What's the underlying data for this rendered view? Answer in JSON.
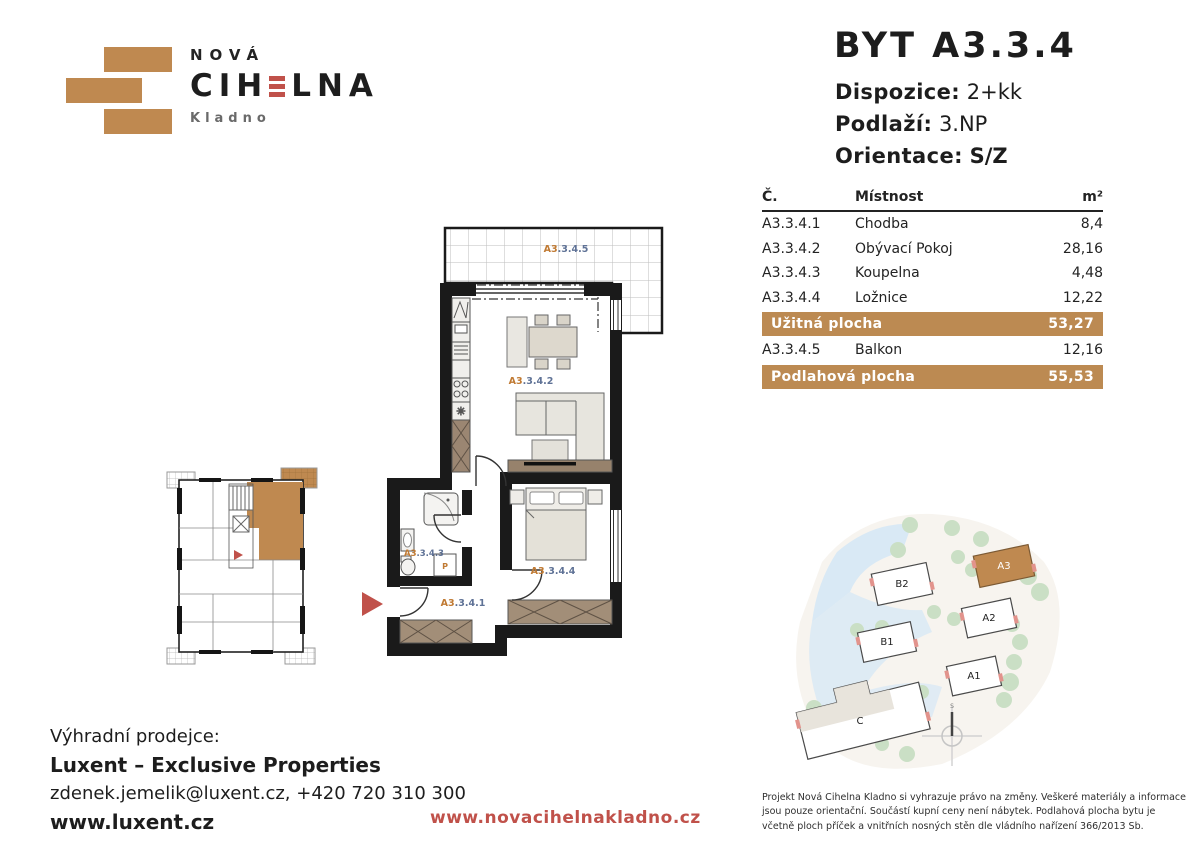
{
  "logo": {
    "name_top": "NOVÁ",
    "name_pre": "CIH",
    "name_post": "LNA",
    "city": "Kladno"
  },
  "unit": {
    "title": "BYT A3.3.4",
    "specs": [
      {
        "label": "Dispozice:",
        "value": "2+kk"
      },
      {
        "label": "Podlaží:",
        "value": "3.NP"
      },
      {
        "label": "Orientace:",
        "value": "S/Z"
      }
    ]
  },
  "table": {
    "headers": {
      "no": "Č.",
      "room": "Místnost",
      "area": "m²"
    },
    "rows": [
      {
        "no": "A3.3.4.1",
        "room": "Chodba",
        "area": "8,4"
      },
      {
        "no": "A3.3.4.2",
        "room": "Obývací Pokoj",
        "area": "28,16"
      },
      {
        "no": "A3.3.4.3",
        "room": "Koupelna",
        "area": "4,48"
      },
      {
        "no": "A3.3.4.4",
        "room": "Ložnice",
        "area": "12,22"
      }
    ],
    "usable": {
      "label": "Užitná plocha",
      "value": "53,27"
    },
    "balcony_row": {
      "no": "A3.3.4.5",
      "room": "Balkon",
      "area": "12,16"
    },
    "floor": {
      "label": "Podlahová plocha",
      "value": "55,53"
    }
  },
  "floorplan": {
    "labels": {
      "balcony": {
        "pre": "A3",
        "post": ".3.4.5"
      },
      "living": {
        "pre": "A3",
        "post": ".3.4.2"
      },
      "bathroom": {
        "pre": "A3",
        "post": ".3.4.3"
      },
      "bedroom": {
        "pre": "A3",
        "post": ".3.4.4"
      },
      "hallway": {
        "pre": "A3",
        "post": ".3.4.1"
      },
      "washer": "P"
    }
  },
  "siteplan": {
    "buildings": {
      "b2": "B2",
      "b1": "B1",
      "a3": "A3",
      "a2": "A2",
      "a1": "A1",
      "c": "C"
    },
    "compass_north": "S"
  },
  "footer": {
    "seller_intro": "Výhradní prodejce:",
    "seller_name": "Luxent – Exclusive Properties",
    "seller_contact": "zdenek.jemelik@luxent.cz, +420 720 310 300",
    "seller_web": "www.luxent.cz",
    "project_web": "www.novacihelnakladno.cz",
    "disclaimer": "Projekt Nová Cihelna Kladno si vyhrazuje právo na změny. Veškeré materiály a informace jsou pouze orientační. Součástí kupní ceny není nábytek. Podlahová plocha bytu je včetně ploch příček a vnitřních nosných stěn dle vládního nařízení 366/2013 Sb."
  },
  "colors": {
    "tan": "#bf8950",
    "red": "#c0514a",
    "ink": "#232323"
  }
}
